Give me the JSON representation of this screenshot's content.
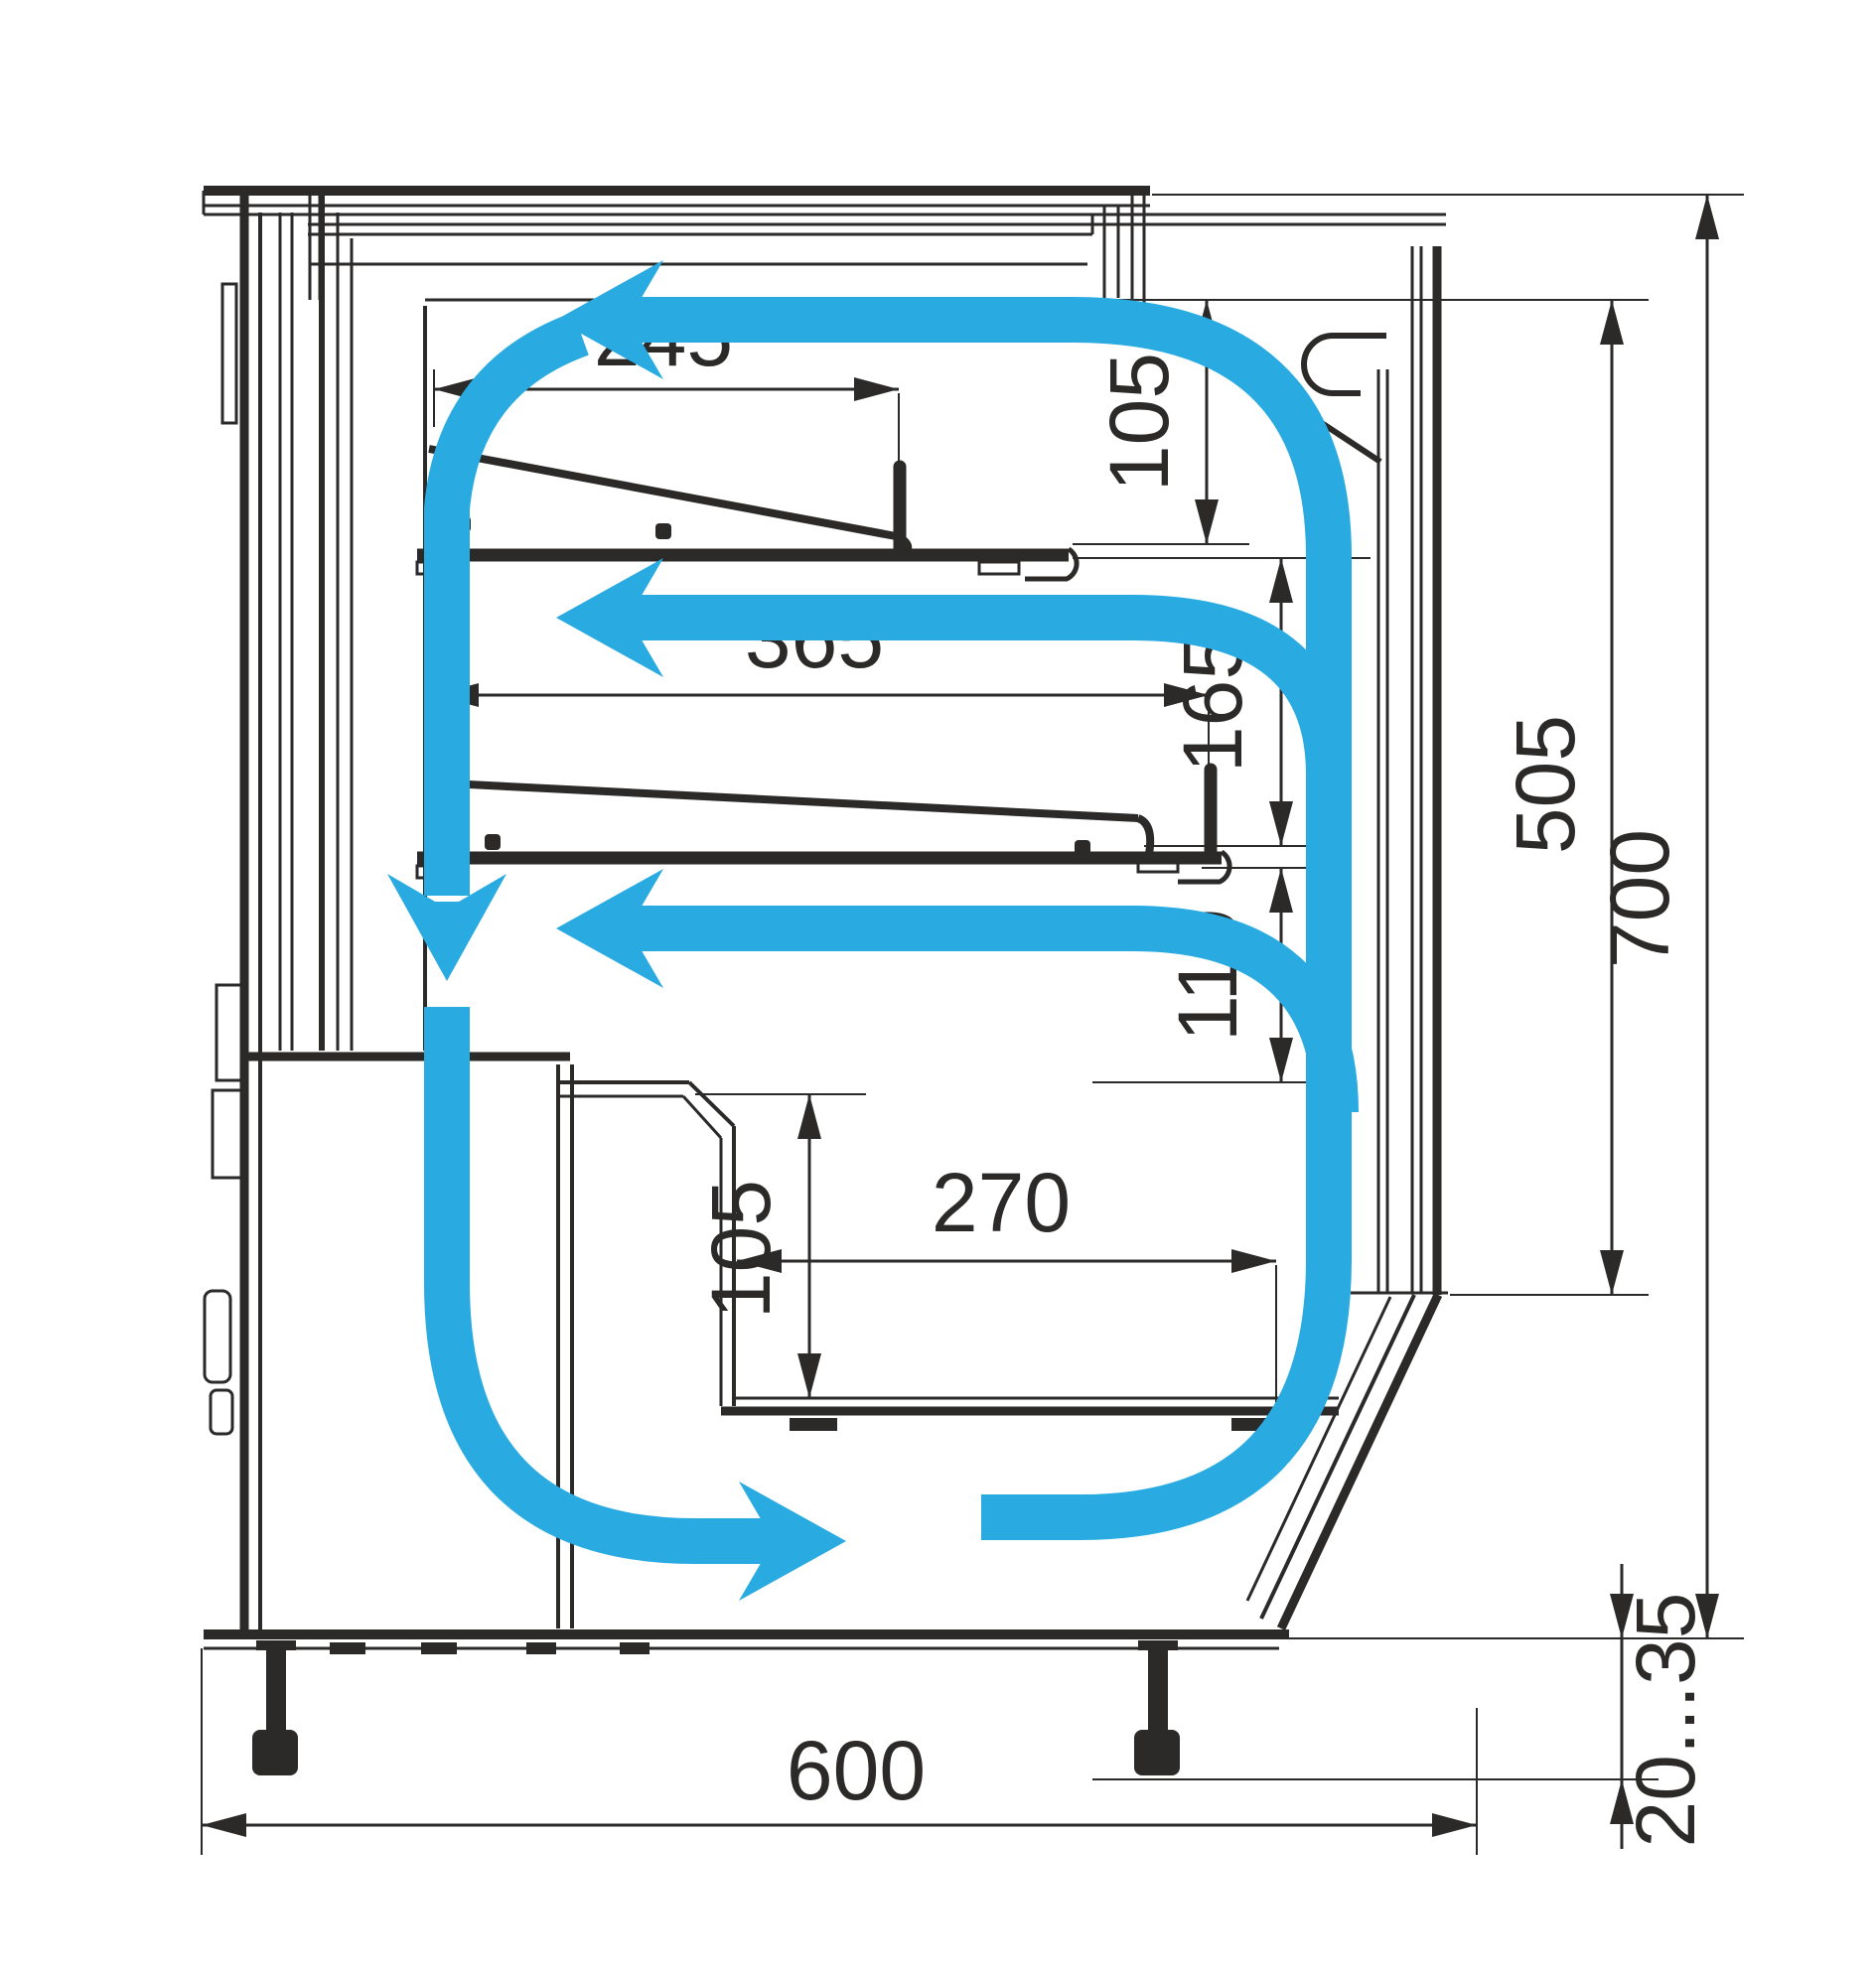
{
  "drawing": {
    "type": "refrigerated-display-case-cross-section",
    "description": "Side cross-section of a confectionery refrigerated display case with air circulation loop",
    "units": "mm",
    "colors": {
      "line": "#2b2a29",
      "airflow": "#29abe2",
      "background": "#ffffff"
    },
    "dimensions": {
      "top_shelf_depth": "245",
      "top_clearance": "105",
      "middle_shelf_depth": "365",
      "middle_clearance": "165",
      "lower_clearance": "110",
      "well_depth": "270",
      "well_height": "105",
      "display_opening_height": "505",
      "overall_height": "700",
      "overall_depth": "600",
      "leg_adjustment_range": "20...35"
    },
    "airflow": {
      "color": "#29abe2",
      "path": "closed circulation loop: down the back wall, right along the base, up the front glass channel, left along the canopy and across both shelves"
    }
  }
}
